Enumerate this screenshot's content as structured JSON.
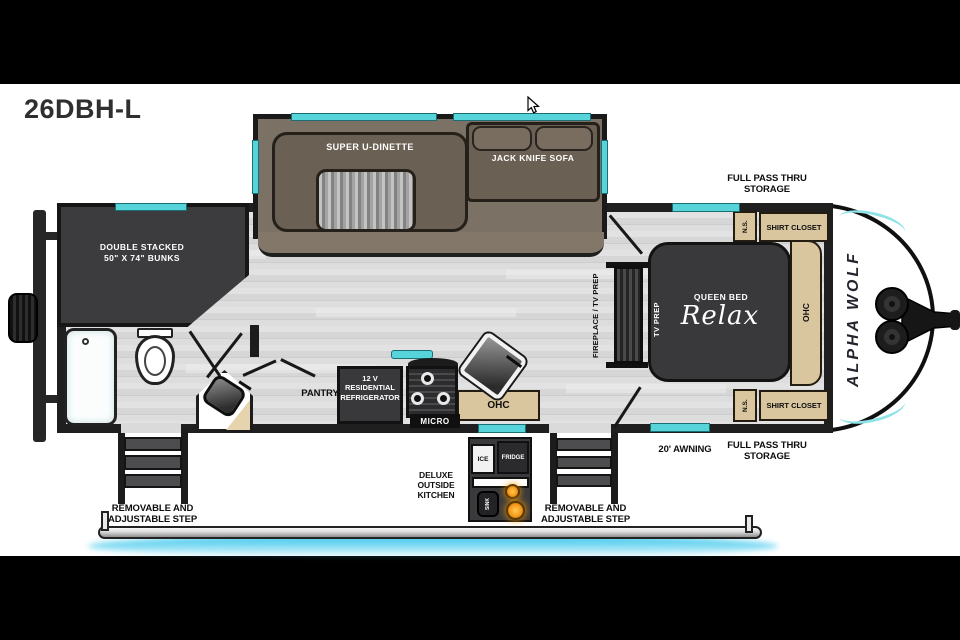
{
  "title": "26DBH-L",
  "slide": {
    "dinette": "SUPER U-DINETTE",
    "sofa": "JACK KNIFE SOFA"
  },
  "bunks": {
    "line1": "DOUBLE STACKED",
    "line2": "50\" X 74\" BUNKS"
  },
  "bedroom": {
    "bed": "QUEEN BED",
    "brand": "Relax",
    "tv_prep": "TV PREP",
    "ohc": "OHC",
    "ns_top": "N.S.",
    "ns_bottom": "N.S.",
    "closet_top": "SHIRT CLOSET",
    "closet_bottom": "SHIRT CLOSET"
  },
  "living": {
    "fireplace": "FIREPLACE / TV PREP",
    "pantry": "PANTRY",
    "fridge_line1": "12 V",
    "fridge_line2": "RESIDENTIAL",
    "fridge_line3": "REFRIGERATOR",
    "micro": "MICRO",
    "ohc": "OHC"
  },
  "exterior": {
    "storage_top": [
      "FULL PASS THRU",
      "STORAGE"
    ],
    "storage_bottom": [
      "FULL PASS THRU",
      "STORAGE"
    ],
    "awning": "20' AWNING",
    "step_left": [
      "REMOVABLE AND",
      "ADJUSTABLE STEP"
    ],
    "step_right": [
      "REMOVABLE AND",
      "ADJUSTABLE STEP"
    ],
    "outside_kitchen": [
      "DELUXE",
      "OUTSIDE",
      "KITCHEN"
    ],
    "ice": "ICE",
    "fridge": "FRIDGE",
    "sink": "SINK",
    "brand": "ALPHA WOLF"
  },
  "colors": {
    "window_teal": "#56d4da",
    "underglow_cyan": "#2fc3ea",
    "cabinet_tan": "#d9c69e",
    "burner_orange": "#f59b1e",
    "wall_dark": "#1f1f1f"
  }
}
